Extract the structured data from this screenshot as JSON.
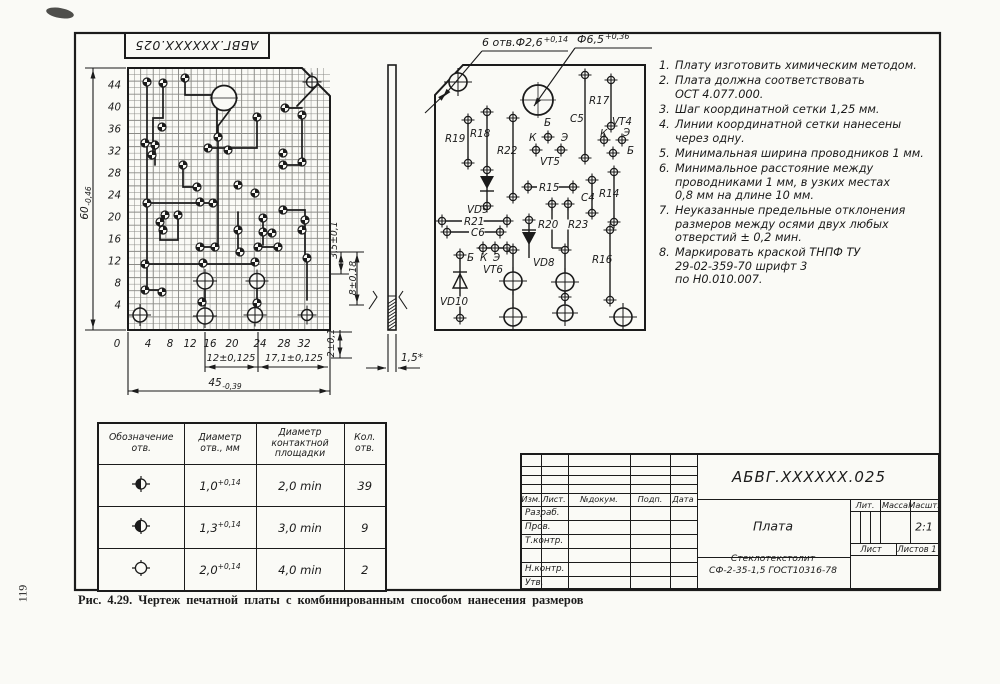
{
  "page": {
    "number": "119",
    "caption": "Рис. 4.29. Чертеж печатной платы с комбинированным способом нанесения размеров"
  },
  "top_stamp": "АБВГ.XXXXXX.025",
  "callouts": {
    "holes": "6 отв.Ф2,6",
    "holes_tol": "+0,14",
    "big_hole": "Ф6,5",
    "big_hole_tol": "+0,36"
  },
  "board_left": {
    "y_ticks": [
      "44",
      "40",
      "36",
      "32",
      "28",
      "24",
      "20",
      "16",
      "12",
      "8",
      "4"
    ],
    "x_ticks": [
      "0",
      "4",
      "8",
      "12",
      "16",
      "20",
      "24",
      "28",
      "32"
    ],
    "dim_height": "60",
    "dim_height_tol": "-0,46",
    "dim_width": "45",
    "dim_width_tol": "-0,39",
    "dim_a": "12±0,125",
    "dim_b": "17,1±0,125",
    "dim_c": "3,5±0,1",
    "dim_d": "8±0,18",
    "dim_e": "2±0,1",
    "thickness": "1,5*"
  },
  "board_right": {
    "labels": [
      "R19",
      "R18",
      "R22",
      "Б",
      "К",
      "Э",
      "VT5",
      "C5",
      "R17",
      "VT4",
      "К",
      "Э",
      "Б",
      "VD9",
      "R21",
      "C6",
      "R15",
      "C4",
      "R14",
      "R20",
      "R23",
      "Б",
      "К",
      "Э",
      "VT6",
      "VD8",
      "VD10",
      "R16"
    ]
  },
  "notes": {
    "items": [
      {
        "num": "1.",
        "text": "Плату изготовить химическим методом."
      },
      {
        "num": "2.",
        "text": "Плата должна соответствовать\nОСТ 4.077.000."
      },
      {
        "num": "3.",
        "text": "Шаг координатной сетки 1,25 мм."
      },
      {
        "num": "4.",
        "text": "Линии координатной сетки нанесены\nчерез одну."
      },
      {
        "num": "5.",
        "text": "Минимальная ширина проводников 1 мм."
      },
      {
        "num": "6.",
        "text": "Минимальное расстояние между\nпроводниками 1 мм, в узких местах\n0,8 мм на длине 10 мм."
      },
      {
        "num": "7.",
        "text": "Неуказанные предельные отклонения\nразмеров между осями двух любых\nотверстий ± 0,2 мин."
      },
      {
        "num": "8.",
        "text": "Маркировать краской ТНПФ ТУ\n29-02-359-70 шрифт 3\nпо Н0.010.007."
      }
    ]
  },
  "table": {
    "headers": [
      "Обозначение\nотв.",
      "Диаметр\nотв., мм",
      "Диаметр\nконтактной\nплощадки",
      "Кол.\nотв."
    ],
    "rows": [
      {
        "dia": "1,0",
        "tol": "+0,14",
        "pad": "2,0 min",
        "count": "39"
      },
      {
        "dia": "1,3",
        "tol": "+0,14",
        "pad": "3,0 min",
        "count": "9"
      },
      {
        "dia": "2,0",
        "tol": "+0,14",
        "pad": "4,0 min",
        "count": "2"
      }
    ]
  },
  "title_block": {
    "designation": "АБВГ.XXXXXX.025",
    "name": "Плата",
    "material": "Стеклотекстолит\nСФ-2-35-1,5 ГОСТ10316-78",
    "scale": "2:1",
    "col_headers": [
      "Изм.",
      "Лист.",
      "№докум.",
      "Подп.",
      "Дата"
    ],
    "row_labels": [
      "Разраб.",
      "Пров.",
      "Т.контр.",
      "",
      "Н.контр.",
      "Утв."
    ],
    "lit": "Лит.",
    "massa": "Масса",
    "masshtab": "Масшт.",
    "sheet": "Лист",
    "sheets": "Листов 1"
  }
}
